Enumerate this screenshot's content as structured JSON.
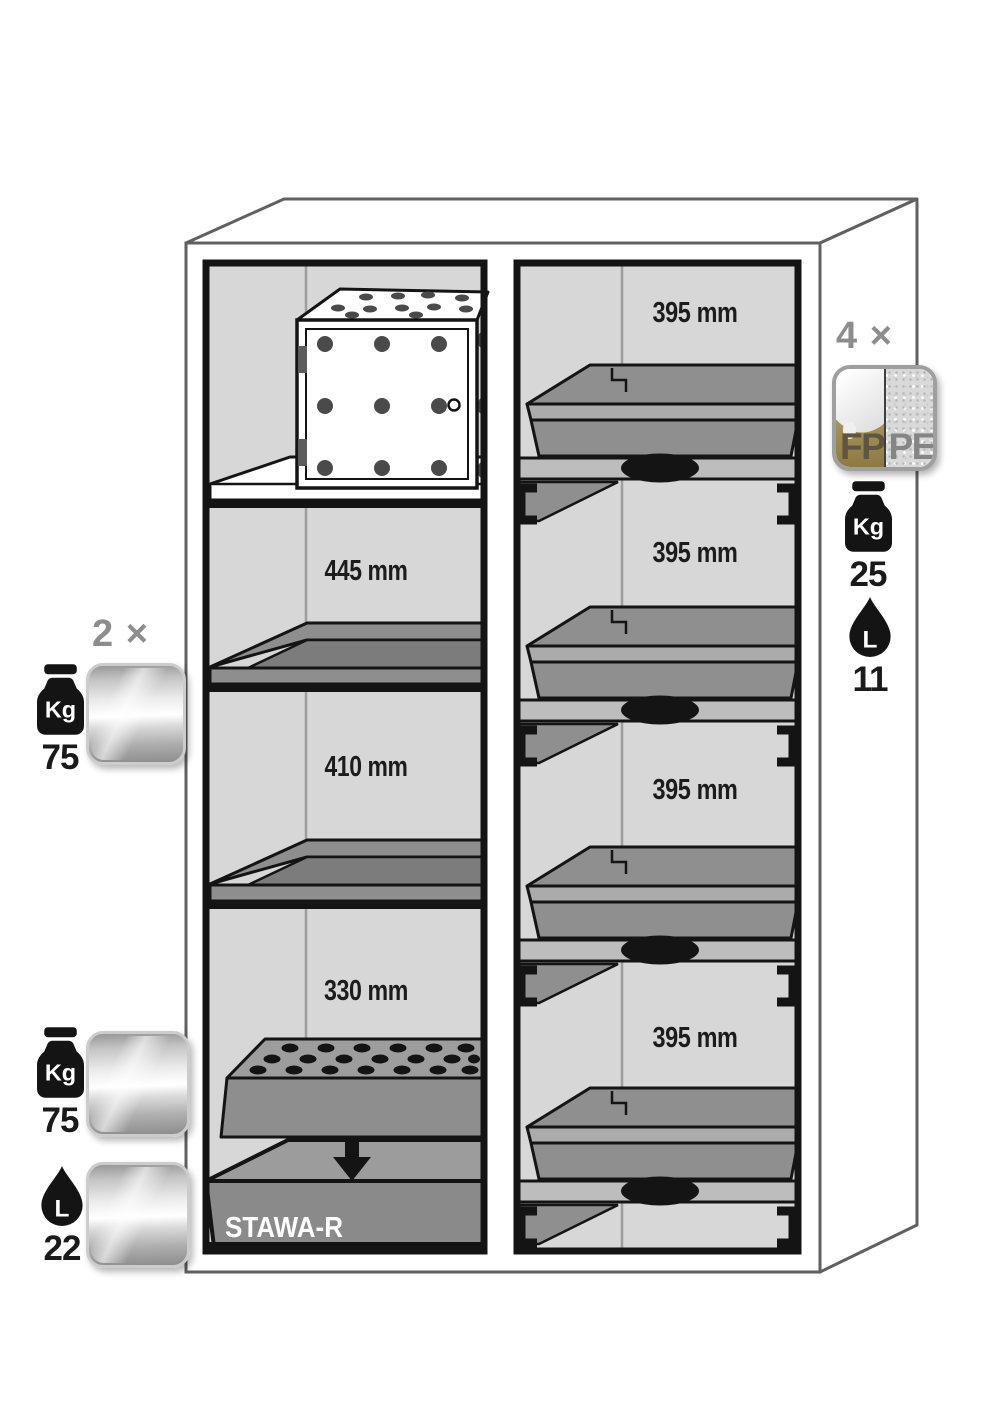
{
  "diagram": {
    "left_compartment": {
      "dim_labels": [
        "445 mm",
        "410 mm",
        "330 mm"
      ],
      "sump_label": "STAWA-R"
    },
    "right_compartment": {
      "drawer_labels": [
        "395 mm",
        "395 mm",
        "395 mm",
        "395 mm"
      ]
    },
    "annotations": {
      "shelf_group": {
        "count": "2 ×",
        "weight_unit": "Kg",
        "weight_value": "75"
      },
      "sump_group": {
        "weight_unit": "Kg",
        "weight_value": "75",
        "volume_unit": "L",
        "volume_value": "22"
      },
      "drawer_group": {
        "count": "4 ×",
        "material_left": "FP",
        "material_right": "PE",
        "weight_unit": "Kg",
        "weight_value": "25",
        "volume_unit": "L",
        "volume_value": "11"
      }
    },
    "colors": {
      "interior_gray": "#d7d7d7",
      "line_black": "#141414",
      "cabinet_line": "#606060",
      "count_gray": "#8d8d8d",
      "fp_gold": "#ab9760",
      "pe_speckle": "#d9d9d9",
      "shelf_gray": "#8e8e8e"
    }
  }
}
